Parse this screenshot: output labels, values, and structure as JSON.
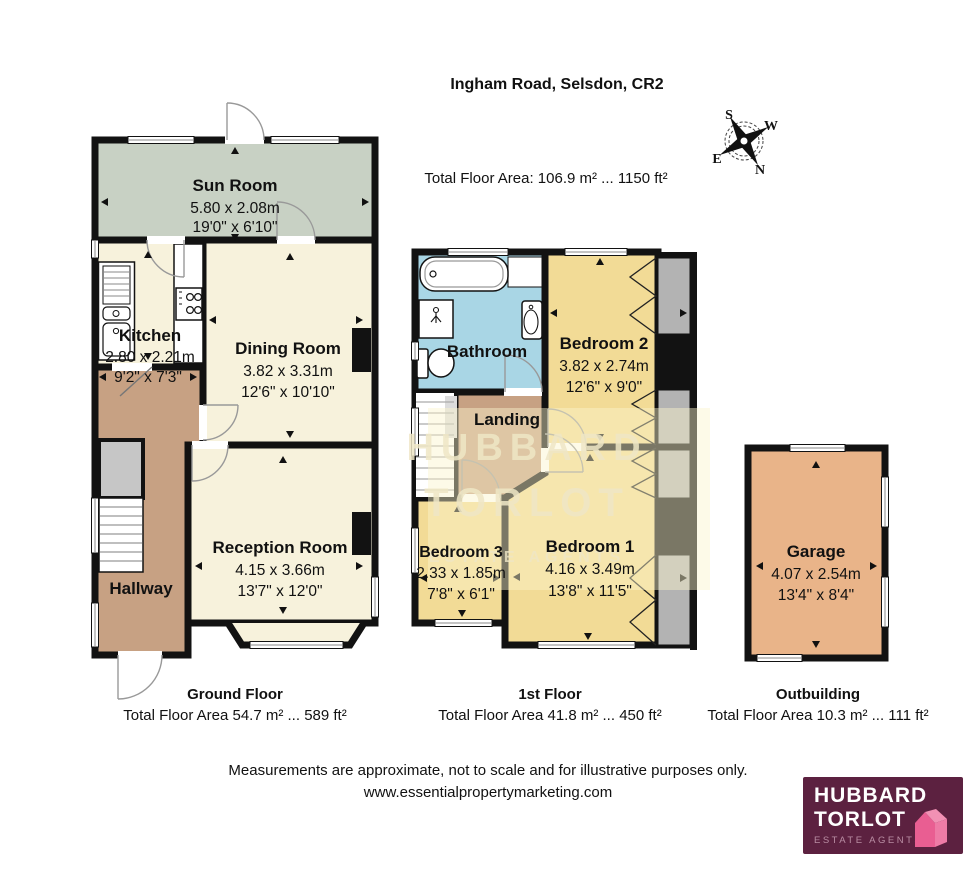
{
  "header": {
    "title": "Ingham Road, Selsdon, CR2",
    "total_area": "Total Floor Area: 106.9 m² ... 1150 ft²"
  },
  "compass": {
    "n": "N",
    "s": "S",
    "e": "E",
    "w": "W"
  },
  "ground_floor": {
    "caption": "Ground Floor",
    "area": "Total Floor Area 54.7 m² ... 589 ft²",
    "sun_room": {
      "name": "Sun Room",
      "metric": "5.80 x 2.08m",
      "imperial": "19'0\" x 6'10\""
    },
    "kitchen": {
      "name": "Kitchen",
      "metric": "2.80 x 2.21m",
      "imperial": "9'2\" x 7'3\""
    },
    "dining_room": {
      "name": "Dining Room",
      "metric": "3.82 x 3.31m",
      "imperial": "12'6\" x 10'10\""
    },
    "hallway": {
      "name": "Hallway"
    },
    "reception_room": {
      "name": "Reception Room",
      "metric": "4.15 x 3.66m",
      "imperial": "13'7\" x 12'0\""
    }
  },
  "first_floor": {
    "caption": "1st Floor",
    "area": "Total Floor Area 41.8 m² ... 450 ft²",
    "bathroom": {
      "name": "Bathroom"
    },
    "bedroom2": {
      "name": "Bedroom 2",
      "metric": "3.82 x 2.74m",
      "imperial": "12'6\" x 9'0\""
    },
    "landing": {
      "name": "Landing"
    },
    "bedroom3": {
      "name": "Bedroom 3",
      "metric": "2.33 x 1.85m",
      "imperial": "7'8\" x 6'1\""
    },
    "bedroom1": {
      "name": "Bedroom 1",
      "metric": "4.16 x 3.49m",
      "imperial": "13'8\" x 11'5\""
    }
  },
  "outbuilding": {
    "caption": "Outbuilding",
    "area": "Total Floor Area 10.3 m² ... 111 ft²",
    "garage": {
      "name": "Garage",
      "metric": "4.07 x 2.54m",
      "imperial": "13'4\" x 8'4\""
    }
  },
  "watermark": {
    "line1": "HUBBARD",
    "line2": "TORLOT",
    "line3": "ESTATE AGENTS"
  },
  "footer": {
    "disclaimer": "Measurements are approximate, not to scale and for illustrative purposes only.",
    "website": "www.essentialpropertymarketing.com"
  },
  "logo": {
    "name_line1": "HUBBARD",
    "name_line2": "TORLOT",
    "tagline": "ESTATE AGENTS"
  },
  "colors": {
    "wall": "#121212",
    "room_cream": "#f7f2dc",
    "sun_room_green": "#c8d1c4",
    "hall_tan": "#c7a183",
    "bedroom_yellow": "#f2db96",
    "bathroom_blue": "#a9d6e5",
    "garage_orange": "#e9b489",
    "wardrobe_gray": "#b3b3b3",
    "logo_bg": "#5c2140",
    "logo_pink": "#e95e92"
  }
}
